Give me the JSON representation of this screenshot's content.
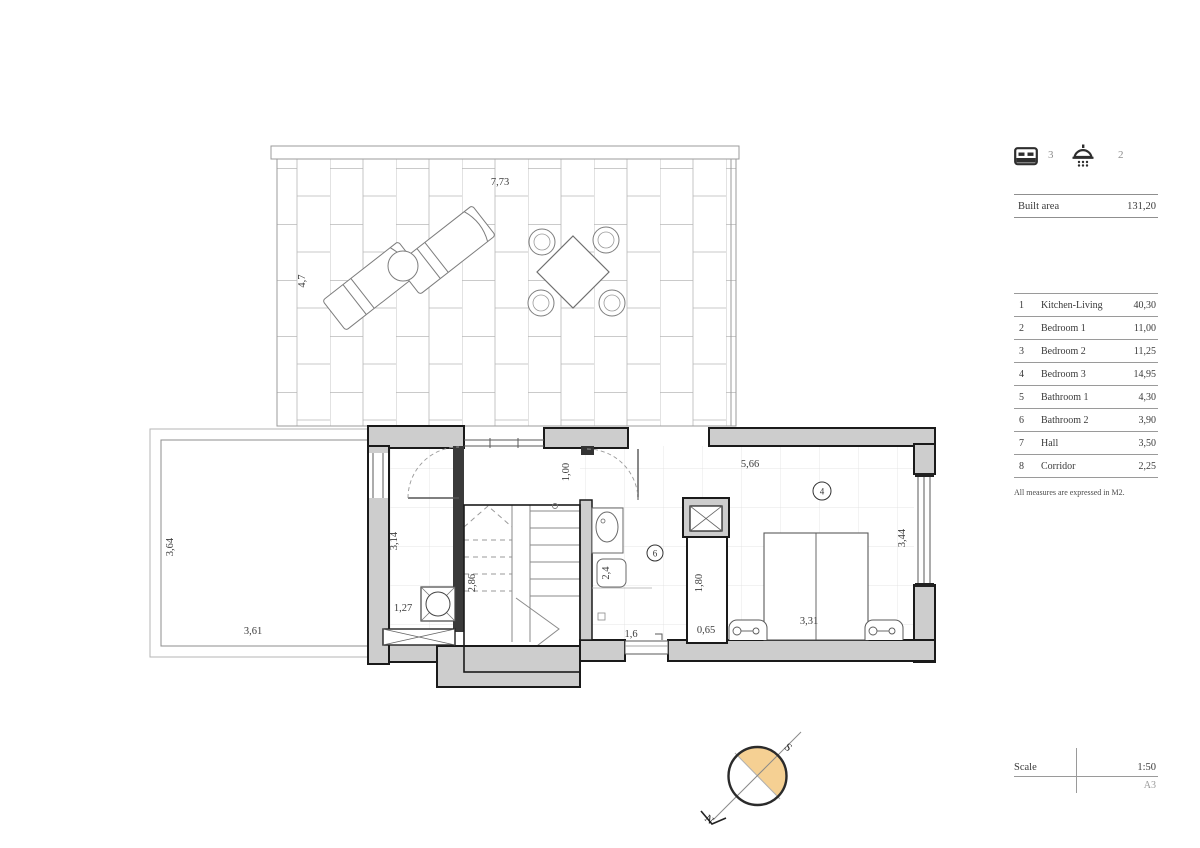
{
  "header": {
    "bedrooms_count": "3",
    "bathrooms_count": "2"
  },
  "built_area": {
    "label": "Built area",
    "value": "131,20"
  },
  "rooms": [
    {
      "num": "1",
      "name": "Kitchen-Living",
      "area": "40,30"
    },
    {
      "num": "2",
      "name": "Bedroom 1",
      "area": "11,00"
    },
    {
      "num": "3",
      "name": "Bedroom 2",
      "area": "11,25"
    },
    {
      "num": "4",
      "name": "Bedroom 3",
      "area": "14,95"
    },
    {
      "num": "5",
      "name": "Bathroom 1",
      "area": "4,30"
    },
    {
      "num": "6",
      "name": "Bathroom 2",
      "area": "3,90"
    },
    {
      "num": "7",
      "name": "Hall",
      "area": "3,50"
    },
    {
      "num": "8",
      "name": "Corridor",
      "area": "2,25"
    }
  ],
  "note": "All measures are expressed in M2.",
  "scale": {
    "label": "Scale",
    "value": "1:50",
    "sheet": "A3"
  },
  "compass": {
    "north": "N",
    "south": "S"
  },
  "plan": {
    "dims": {
      "terrace_width": "7,73",
      "terrace_depth": "4,7",
      "solarium_width": "3,61",
      "solarium_depth": "3,64",
      "utility_width": "1,27",
      "utility_depth": "3,14",
      "stairs_depth": "2,86",
      "stairs_width": "2,08",
      "hall_width": "1,00",
      "shower": "2,4",
      "bath_width": "1,6",
      "closet_depth": "1,80",
      "closet_width": "0,65",
      "bedroom_width": "5,66",
      "bedroom_depth": "3,44",
      "bed_width": "3,31"
    },
    "markers": {
      "bedroom3": "4",
      "bathroom2": "6"
    }
  },
  "colors": {
    "wall_fill": "#cdcdcd",
    "line_dark": "#1a1a1a",
    "compass_tan": "#f5d093"
  }
}
